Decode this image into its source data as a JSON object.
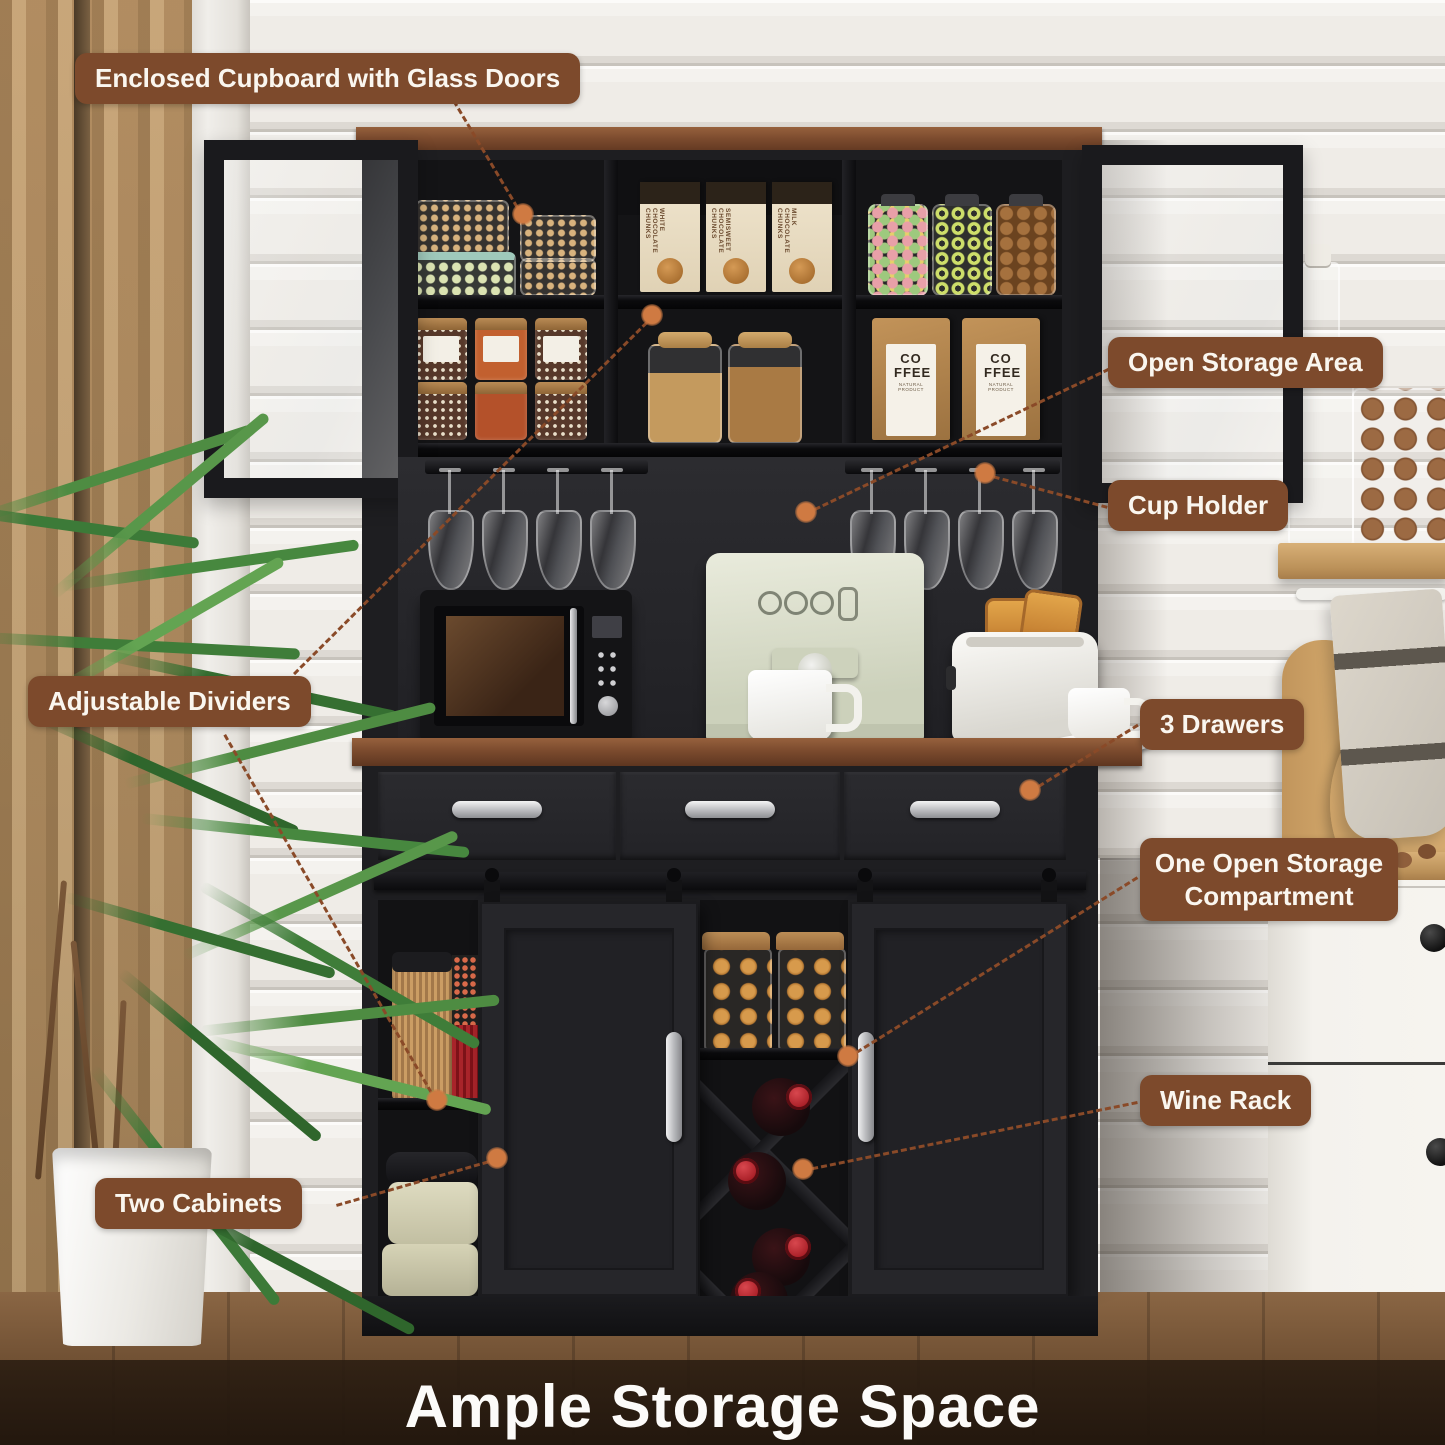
{
  "callouts": {
    "enclosed_cupboard": "Enclosed Cupboard with Glass Doors",
    "open_storage_area": "Open Storage Area",
    "cup_holder": "Cup Holder",
    "adjustable_dividers": "Adjustable Dividers",
    "three_drawers": "3 Drawers",
    "open_compartment": "One Open Storage Compartment",
    "wine_rack": "Wine Rack",
    "two_cabinets": "Two Cabinets"
  },
  "banner": {
    "title": "Ample Storage Space"
  },
  "products": {
    "coffee_bag_text": "CO FFEE",
    "coffee_bag_subtext": "NATURAL PRODUCT",
    "choc_box_white": "WHITE CHOCOLATE CHUNKS",
    "choc_box_semisweet": "SEMISWEET CHOCOLATE CHUNKS",
    "choc_box_milk": "MILK CHOCOLATE CHUNKS"
  },
  "colors": {
    "callout_bg": "#7d4a2c",
    "callout_text": "#faf6ef",
    "connector": "#8a4a28",
    "dot": "#cf7a42",
    "cabinet_black": "#1e1e21",
    "wood_trim": "#8a5434",
    "banner_text": "#fcfbf9"
  }
}
